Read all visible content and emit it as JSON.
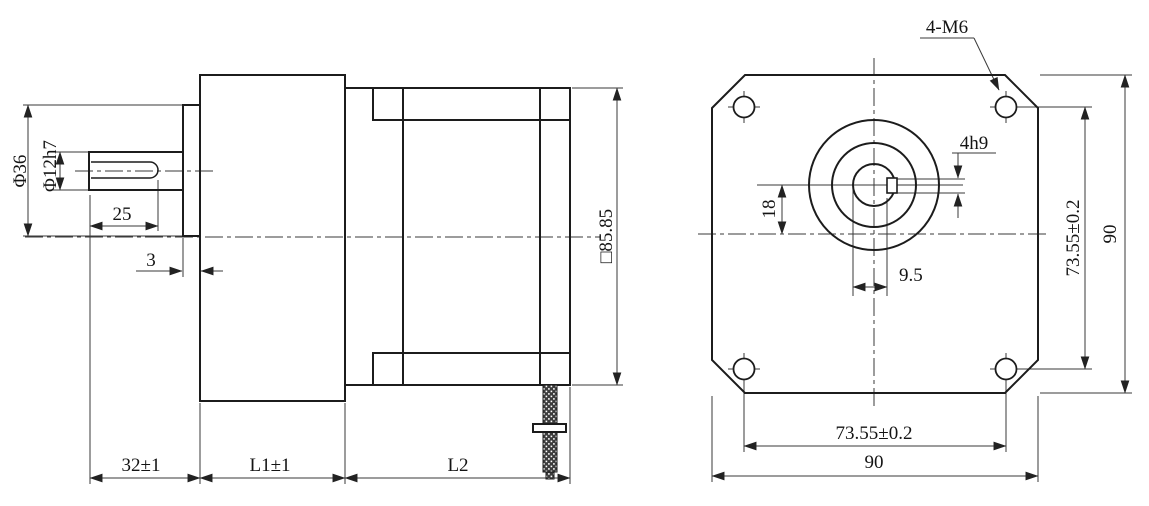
{
  "side_view": {
    "shaft_diameter": "Φ12h7",
    "boss_diameter": "Φ36",
    "keyway_length": "25",
    "spacer_width": "3",
    "shaft_length": "32±1",
    "gearbox_length": "L1±1",
    "motor_length": "L2",
    "frame_size": "□85.85"
  },
  "front_view": {
    "mounting_holes": "4-M6",
    "keyway_width": "4h9",
    "shaft_offset": "18",
    "keyway_flat": "9.5",
    "hole_pitch_vertical": "73.55±0.2",
    "body_height": "90",
    "hole_pitch_horizontal": "73.55±0.2",
    "body_width": "90"
  }
}
